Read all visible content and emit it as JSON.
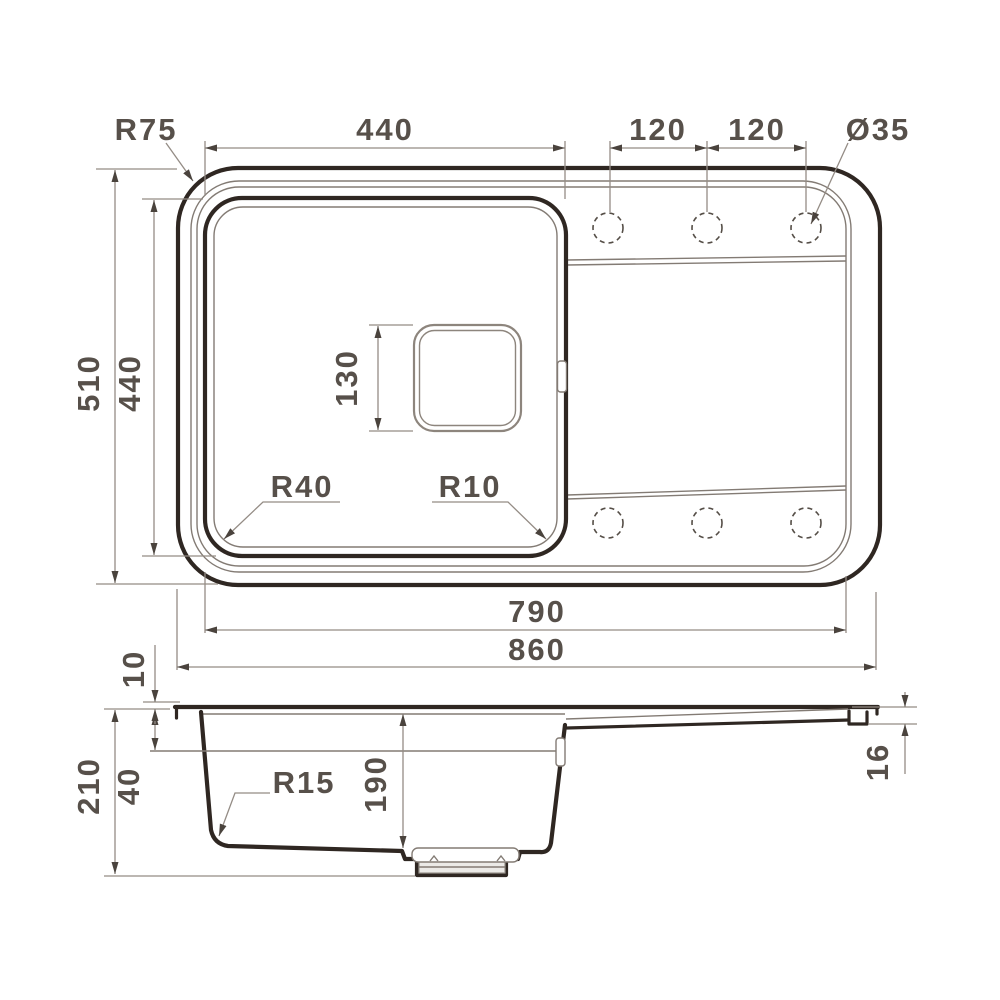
{
  "drawing": {
    "title": "kitchen sink dimensional drawing",
    "colors": {
      "ink": "#2f2722",
      "thin_line": "#837b74",
      "dim_line": "#948c85",
      "text": "#57504a",
      "background": "#ffffff"
    },
    "views": {
      "top_view_features": [
        "bowl",
        "drainboard",
        "six tap holes (dashed)",
        "drain square"
      ],
      "side_view_features": [
        "bowl section",
        "drain fitting",
        "drainboard slope"
      ]
    }
  },
  "labels": {
    "bowl_width": "440",
    "hole_pitch_a": "120",
    "hole_pitch_b": "120",
    "hole_diameter": "Ø35",
    "rim_corner_radius": "R75",
    "overall_depth": "510",
    "bowl_front_to_back": "440",
    "drain_square_size": "130",
    "bowl_corner_radius_outer": "R40",
    "bowl_corner_radius_inner": "R10",
    "usable_length": "790",
    "overall_length": "860",
    "rim_lip_height": "10",
    "ledge_drop": "40",
    "overall_height": "210",
    "bowl_bottom_radius": "R15",
    "bowl_depth": "190",
    "edge_thickness": "16"
  }
}
